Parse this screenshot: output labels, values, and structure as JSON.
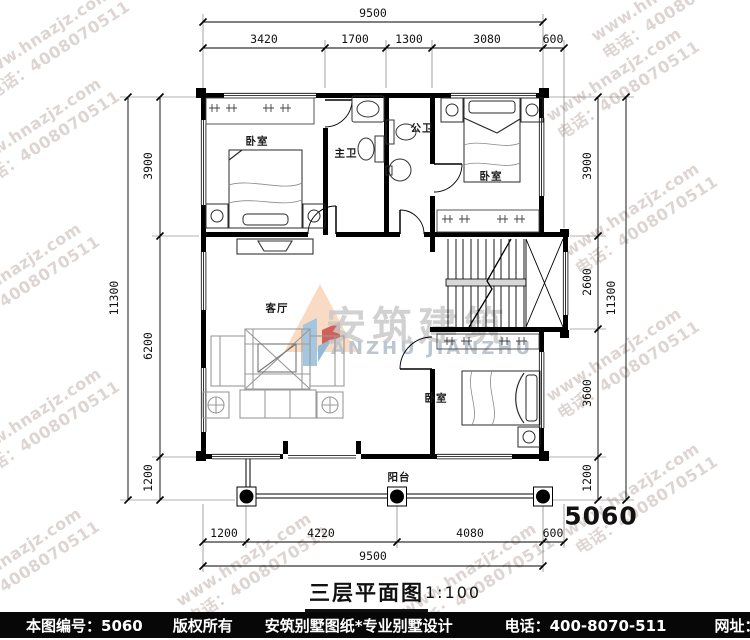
{
  "watermark": {
    "line1": "www.hnazjz.com",
    "line2": "电话：4008070511"
  },
  "logo": {
    "cn": "安筑建筑",
    "en": "ANZHU JIANZHU"
  },
  "plan": {
    "title": "三层平面图",
    "scale": "1:100",
    "drawing_no": "5060",
    "rooms": {
      "bedroom_tl": "卧室",
      "master_bath": "主卫",
      "public_bath": "公卫",
      "bedroom_tr": "卧室",
      "living": "客厅",
      "bedroom_br": "卧室",
      "balcony": "阳台"
    }
  },
  "dims": {
    "top": {
      "total": "9500",
      "segments": [
        "3420",
        "1700",
        "1300",
        "3080",
        "600"
      ]
    },
    "bottom": {
      "total": "9500",
      "segments": [
        "1200",
        "4220",
        "4080",
        "600"
      ]
    },
    "left": {
      "total": "11300",
      "segments": [
        "3900",
        "6200",
        "1200"
      ]
    },
    "right": {
      "total": "11300",
      "segments": [
        "3900",
        "2600",
        "3600",
        "1200"
      ]
    }
  },
  "footer": {
    "number": "本图编号：5060",
    "copyright": "版权所有",
    "company": "安筑别墅图纸*专业别墅设计",
    "phone": "电话：400-8070-511",
    "website": "网址：www.hnazjz.com"
  },
  "colors": {
    "footer_bg": "#070707",
    "line_black": "#000000",
    "furniture_gray": "#9a9a9a",
    "watermark_gray": "#a5918a",
    "logo_peach": "#f8d2b4",
    "logo_blue": "#8fb8d8",
    "logo_red": "#c5392f"
  }
}
